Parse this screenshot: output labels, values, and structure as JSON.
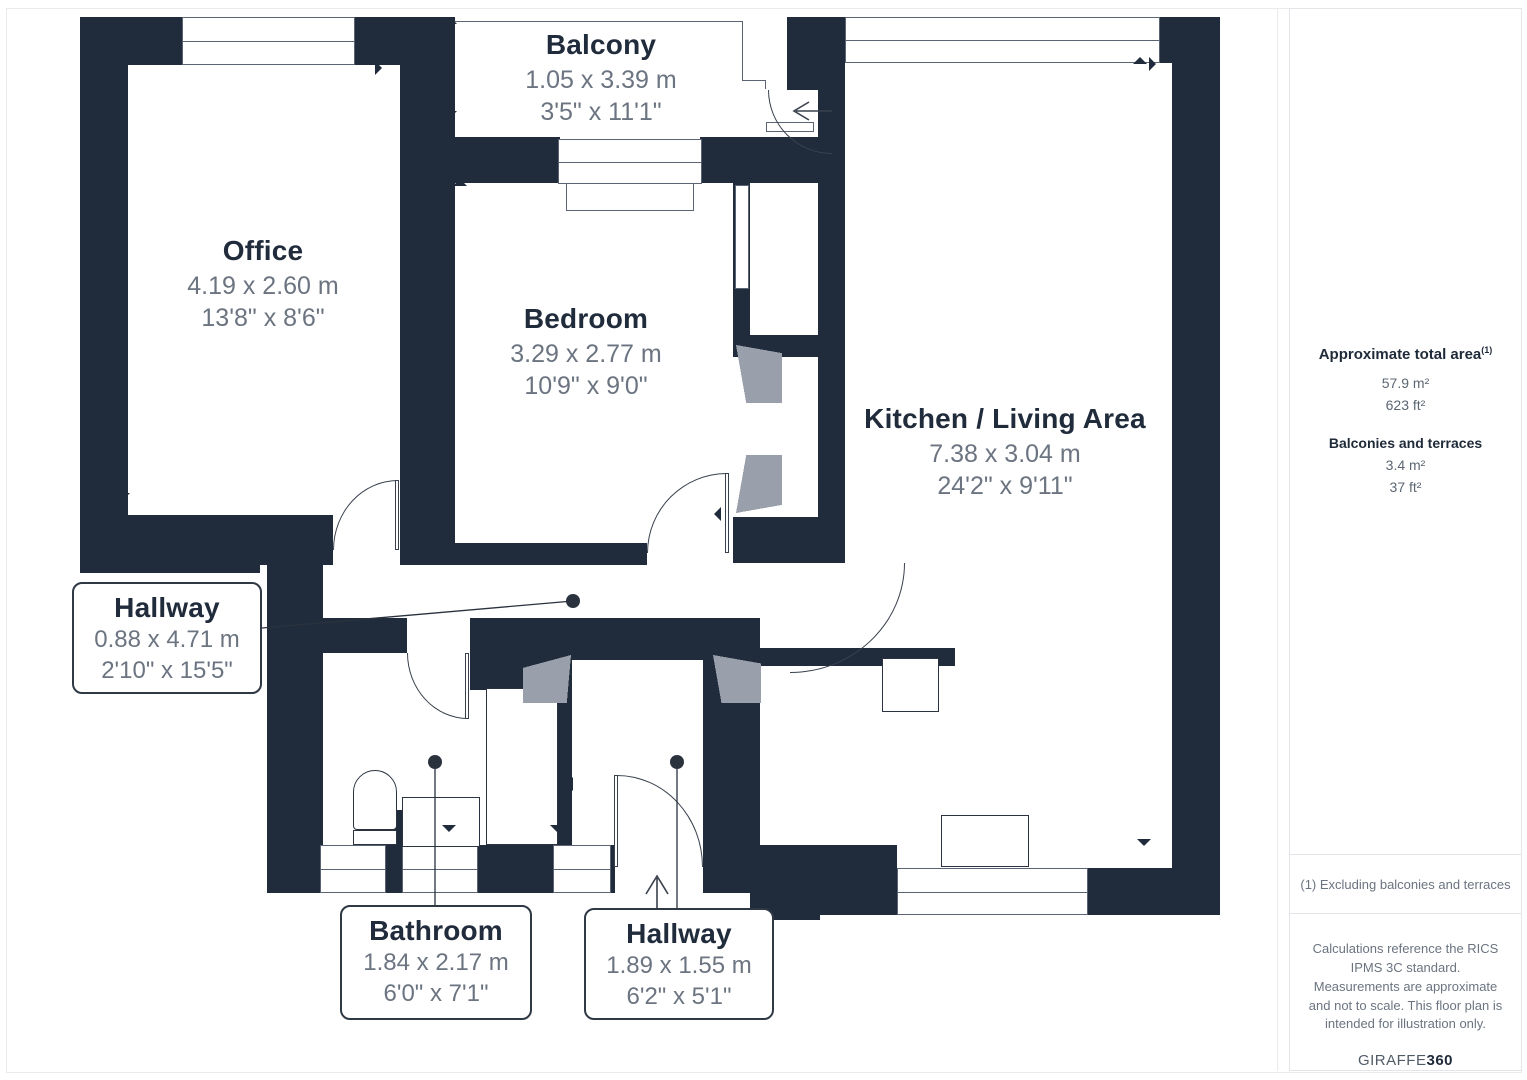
{
  "plan": {
    "rooms": [
      {
        "id": "office",
        "name": "Office",
        "metric": "4.19 x 2.60 m",
        "imperial": "13'8\" x 8'6\""
      },
      {
        "id": "balcony",
        "name": "Balcony",
        "metric": "1.05 x 3.39 m",
        "imperial": "3'5\" x 11'1\""
      },
      {
        "id": "bedroom",
        "name": "Bedroom",
        "metric": "3.29 x 2.77 m",
        "imperial": "10'9\" x 9'0\""
      },
      {
        "id": "kitchen-living",
        "name": "Kitchen / Living Area",
        "metric": "7.38 x 3.04 m",
        "imperial": "24'2\" x 9'11\""
      }
    ],
    "callouts": [
      {
        "id": "hallway-main",
        "name": "Hallway",
        "metric": "0.88 x 4.71 m",
        "imperial": "2'10\" x 15'5\""
      },
      {
        "id": "bathroom",
        "name": "Bathroom",
        "metric": "1.84 x 2.17 m",
        "imperial": "6'0\" x 7'1\""
      },
      {
        "id": "hallway-entry",
        "name": "Hallway",
        "metric": "1.89 x 1.55 m",
        "imperial": "6'2\" x 5'1\""
      }
    ]
  },
  "sidebar": {
    "total_area_label": "Approximate total area",
    "total_area_footnote_marker": "(1)",
    "total_area_m2": "57.9 m²",
    "total_area_ft2": "623 ft²",
    "balconies_label": "Balconies and terraces",
    "balconies_m2": "3.4 m²",
    "balconies_ft2": "37 ft²",
    "footnote": "(1) Excluding balconies and terraces",
    "disclaimer": "Calculations reference the RICS IPMS 3C standard. Measurements are approximate and not to scale. This floor plan is intended for illustration only.",
    "brand_name": "GIRAFFE",
    "brand_suffix": "360"
  },
  "colors": {
    "wall": "#202b3b",
    "dimension_text": "#6b7480"
  }
}
